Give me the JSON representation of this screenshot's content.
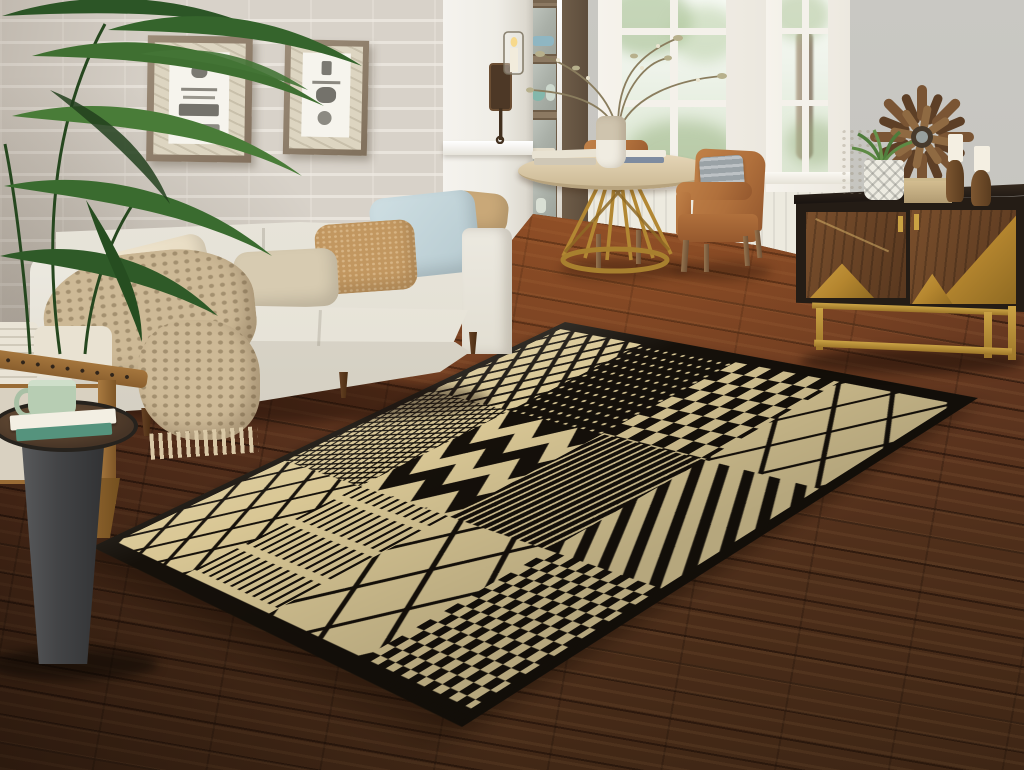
{
  "meta": {
    "type": "photograph",
    "subject": "living room interior staged with black and cream patchwork area rug",
    "canvas_width": 1024,
    "canvas_height": 770
  },
  "palette": {
    "rug_cream": "#d9c795",
    "rug_black": "#15100a",
    "floor_warm": "#8e4f2a",
    "floor_dark": "#3e2615",
    "sofa_fabric": "#e9e5dc",
    "brick_wall": "#d8d2c9",
    "gray_wall": "#c7c6c0",
    "brass": "#b5862f",
    "leather_tan": "#b0703c",
    "leaf_green": "#3c6b33"
  },
  "scene": {
    "plant": {
      "label": "Potted palm plant"
    },
    "planter": {
      "label": "White woven planter"
    },
    "brick_wall": {
      "label": "White painted brick wall"
    },
    "artwork": {
      "frame1": {
        "label": "Framed vintage kitchen sketch print"
      },
      "frame2": {
        "label": "Framed vintage utensil sketch print"
      }
    },
    "column": {
      "label": "White column"
    },
    "sconce": {
      "label": "Bronze candle wall sconce with glass shade"
    },
    "cabinet": {
      "label": "Wood and glass display cabinet with dishware"
    },
    "window_left": {
      "label": "Paned window with garden view"
    },
    "window_right": {
      "label": "Narrow paned window with tree view"
    },
    "dining": {
      "table": {
        "label": "Round wood dining table with brass rod base"
      },
      "chair_back": {
        "label": "Tan leather dining chair behind table"
      },
      "chair_right": {
        "label": "Tan leather armchair with gray fringed pillow"
      },
      "vase": {
        "label": "Two-tone ceramic vase with dried branches"
      },
      "books": {
        "label": "Stacked books on tabletop"
      }
    },
    "credenza": {
      "label": "Espresso credenza with walnut and brass geometric doors on gold base",
      "decor": {
        "vase": "Cream textured vase",
        "plant": "Succulent in patterned white pot",
        "box": "Woven storage box",
        "candles": "Turned wood candlesticks with white pillar candles"
      },
      "sunburst": {
        "label": "Driftwood sunburst wall decor"
      }
    },
    "sofa": {
      "label": "Cream upholstered three-seat sofa",
      "pillows": [
        "Tan corner pillow",
        "Light blue pillow",
        "Tan pillow",
        "Beige lumbar pillow",
        "Cream pillow"
      ],
      "throw": "Chunky knit cream throw blanket with fringe"
    },
    "rug": {
      "label": "Black and cream tribal patchwork area rug",
      "patterns": [
        "diamond lattice",
        "woven crosshatch",
        "bold chevron",
        "wavy stripes",
        "checkerboard",
        "diagonal stripes",
        "comb dashes",
        "dotted field"
      ]
    },
    "armchair": {
      "label": "Wood-frame accent chair with nailhead trim"
    },
    "side_table": {
      "label": "Charcoal pedestal side table",
      "mug": "Sage green mug",
      "books": "Two stacked books"
    },
    "floor": {
      "label": "Dark hardwood plank floor"
    }
  }
}
